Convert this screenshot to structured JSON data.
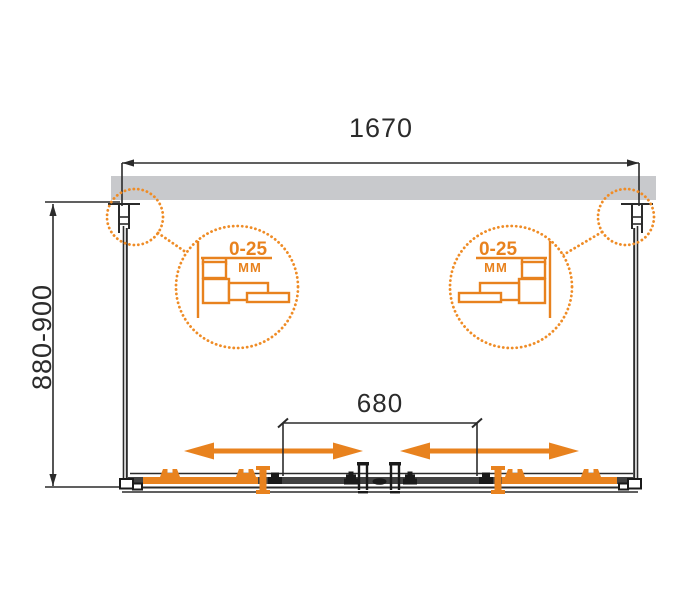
{
  "drawing": {
    "title": "shower-enclosure-plan-view-technical-drawing",
    "top_dimension": {
      "label": "1670"
    },
    "side_dimension": {
      "label": "880-900"
    },
    "opening_dimension": {
      "label": "680"
    },
    "detail_left": {
      "value": "0-25",
      "unit": "MM"
    },
    "detail_right": {
      "value": "0-25",
      "unit": "MM"
    },
    "colors": {
      "accent_orange": "#E8821E",
      "wall_gray": "#C8C9CC",
      "line_dark": "#2B2B2B"
    }
  }
}
